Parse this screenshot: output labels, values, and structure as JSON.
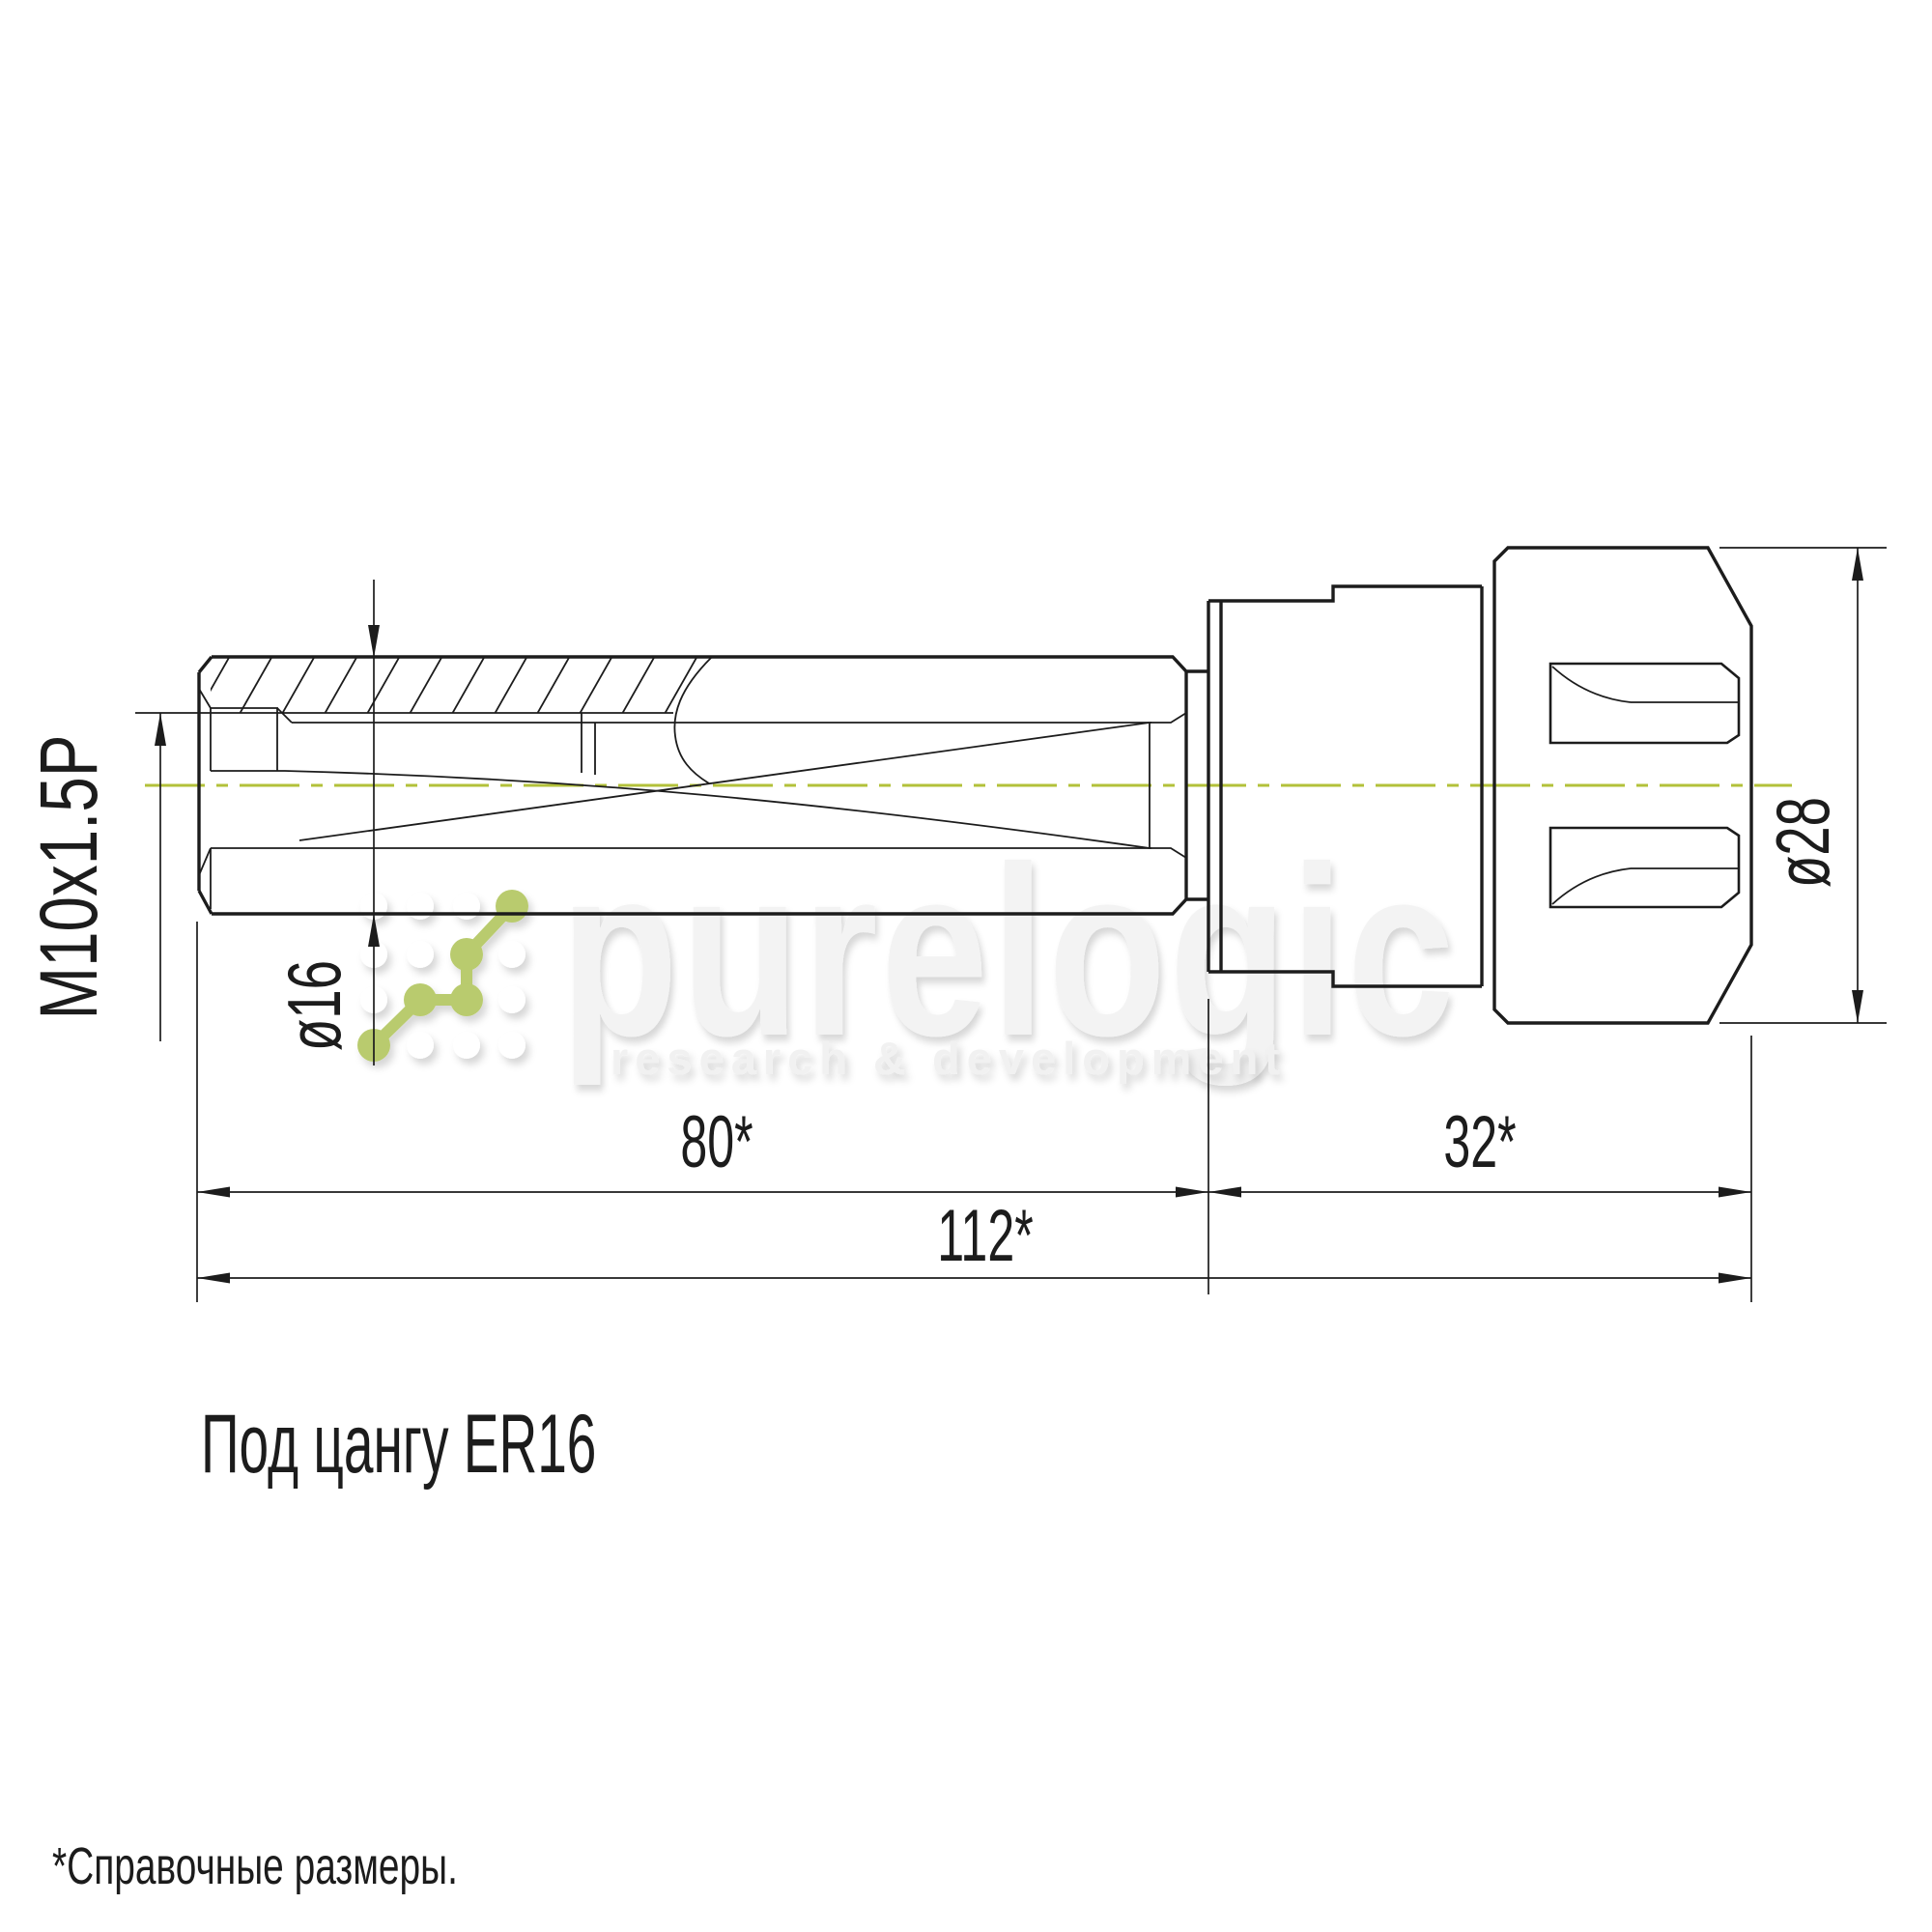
{
  "drawing": {
    "note_label": "Под цангу ER16",
    "footnote": "*Справочные размеры.",
    "dimensions": {
      "thread": "M10x1.5P",
      "shank_diameter": "ø16",
      "nut_diameter": "ø28",
      "shank_length": "80*",
      "nut_length": "32*",
      "total_length": "112*"
    },
    "colors": {
      "line": "#1c1c1c",
      "centerline_green": "#b3c13a",
      "logo_green": "#b9cb6e",
      "watermark_gray": "#f3f3f3"
    }
  },
  "watermark": {
    "brand": "purelogic",
    "tagline": "research & development"
  }
}
